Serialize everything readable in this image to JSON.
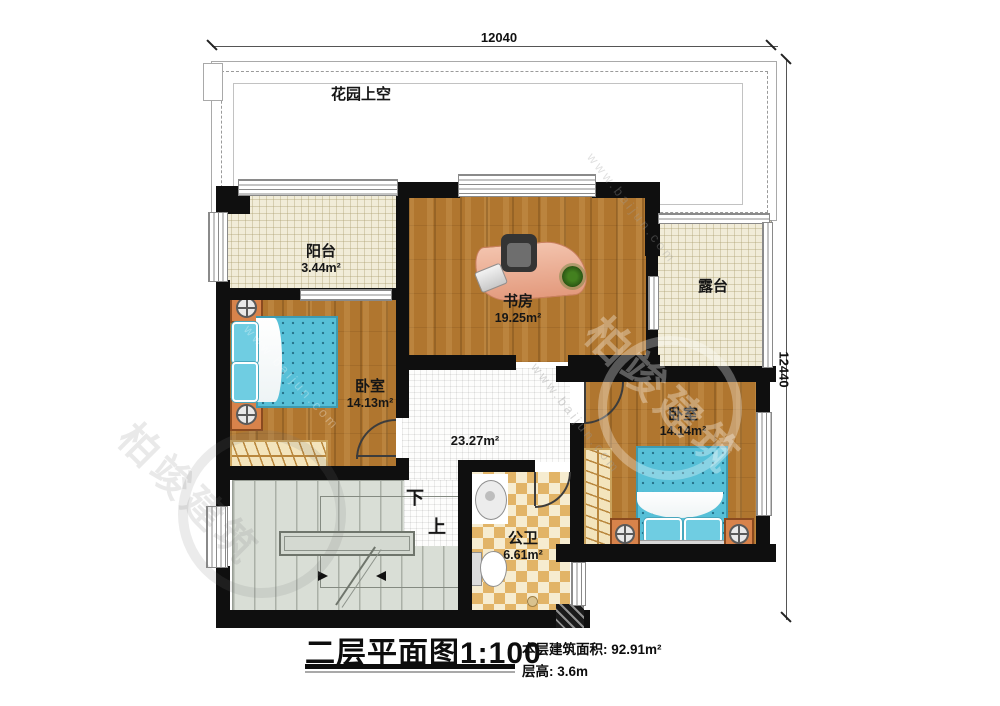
{
  "plan": {
    "title": "二层平面图1:100",
    "area_line": "本层建筑面积: 92.91m²",
    "height_line": "层高: 3.6m",
    "dim_top": "12040",
    "dim_right": "12440",
    "garden_label": "花园上空",
    "rooms": {
      "balcony": {
        "name": "阳台",
        "area": "3.44m²"
      },
      "study": {
        "name": "书房",
        "area": "19.25m²"
      },
      "terrace": {
        "name": "露台"
      },
      "bedroom_left": {
        "name": "卧室",
        "area": "14.13m²"
      },
      "bedroom_right": {
        "name": "卧室",
        "area": "14.14m²"
      },
      "bathroom": {
        "name": "公卫",
        "area": "6.61m²"
      },
      "hall": {
        "area": "23.27m²"
      }
    },
    "stairs": {
      "down": "下",
      "up": "上"
    },
    "watermark": {
      "brand": "柏竣建筑",
      "url": "www.baijun.com"
    },
    "colors": {
      "wall": "#0f0f0f",
      "wood_floor": "#b0762f",
      "tile_cream": "#f1ecd8",
      "bed_blue": "#57c0d8",
      "bath_checker": "#e2b467",
      "stairs_gray": "#d9ded6"
    }
  }
}
